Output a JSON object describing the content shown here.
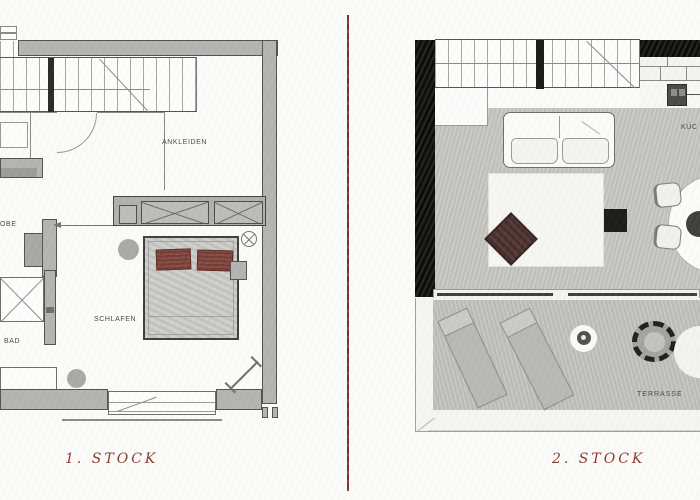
{
  "colors": {
    "page_bg": "#fbfbf9",
    "divider": "#7c312c",
    "caption": "#8b3a33",
    "wall_gray": "#b4b4b2",
    "floor_gray": "#c6c6c3",
    "terrace_gray": "#c1c1be",
    "black_wall": "#161614",
    "pillow_red": "#8a4c43",
    "chair_brown": "#573c38",
    "label_gray": "#4a4a48"
  },
  "left_plan": {
    "caption": "1. STOCK",
    "labels": {
      "ankleiden": "ANKLEIDEN",
      "schlafen": "SCHLAFEN",
      "bad": "BAD",
      "garderobe_partial": "OBE"
    }
  },
  "right_plan": {
    "caption": "2. STOCK",
    "labels": {
      "kueche_partial": "KÜC",
      "terrasse": "TERRASSE"
    }
  }
}
